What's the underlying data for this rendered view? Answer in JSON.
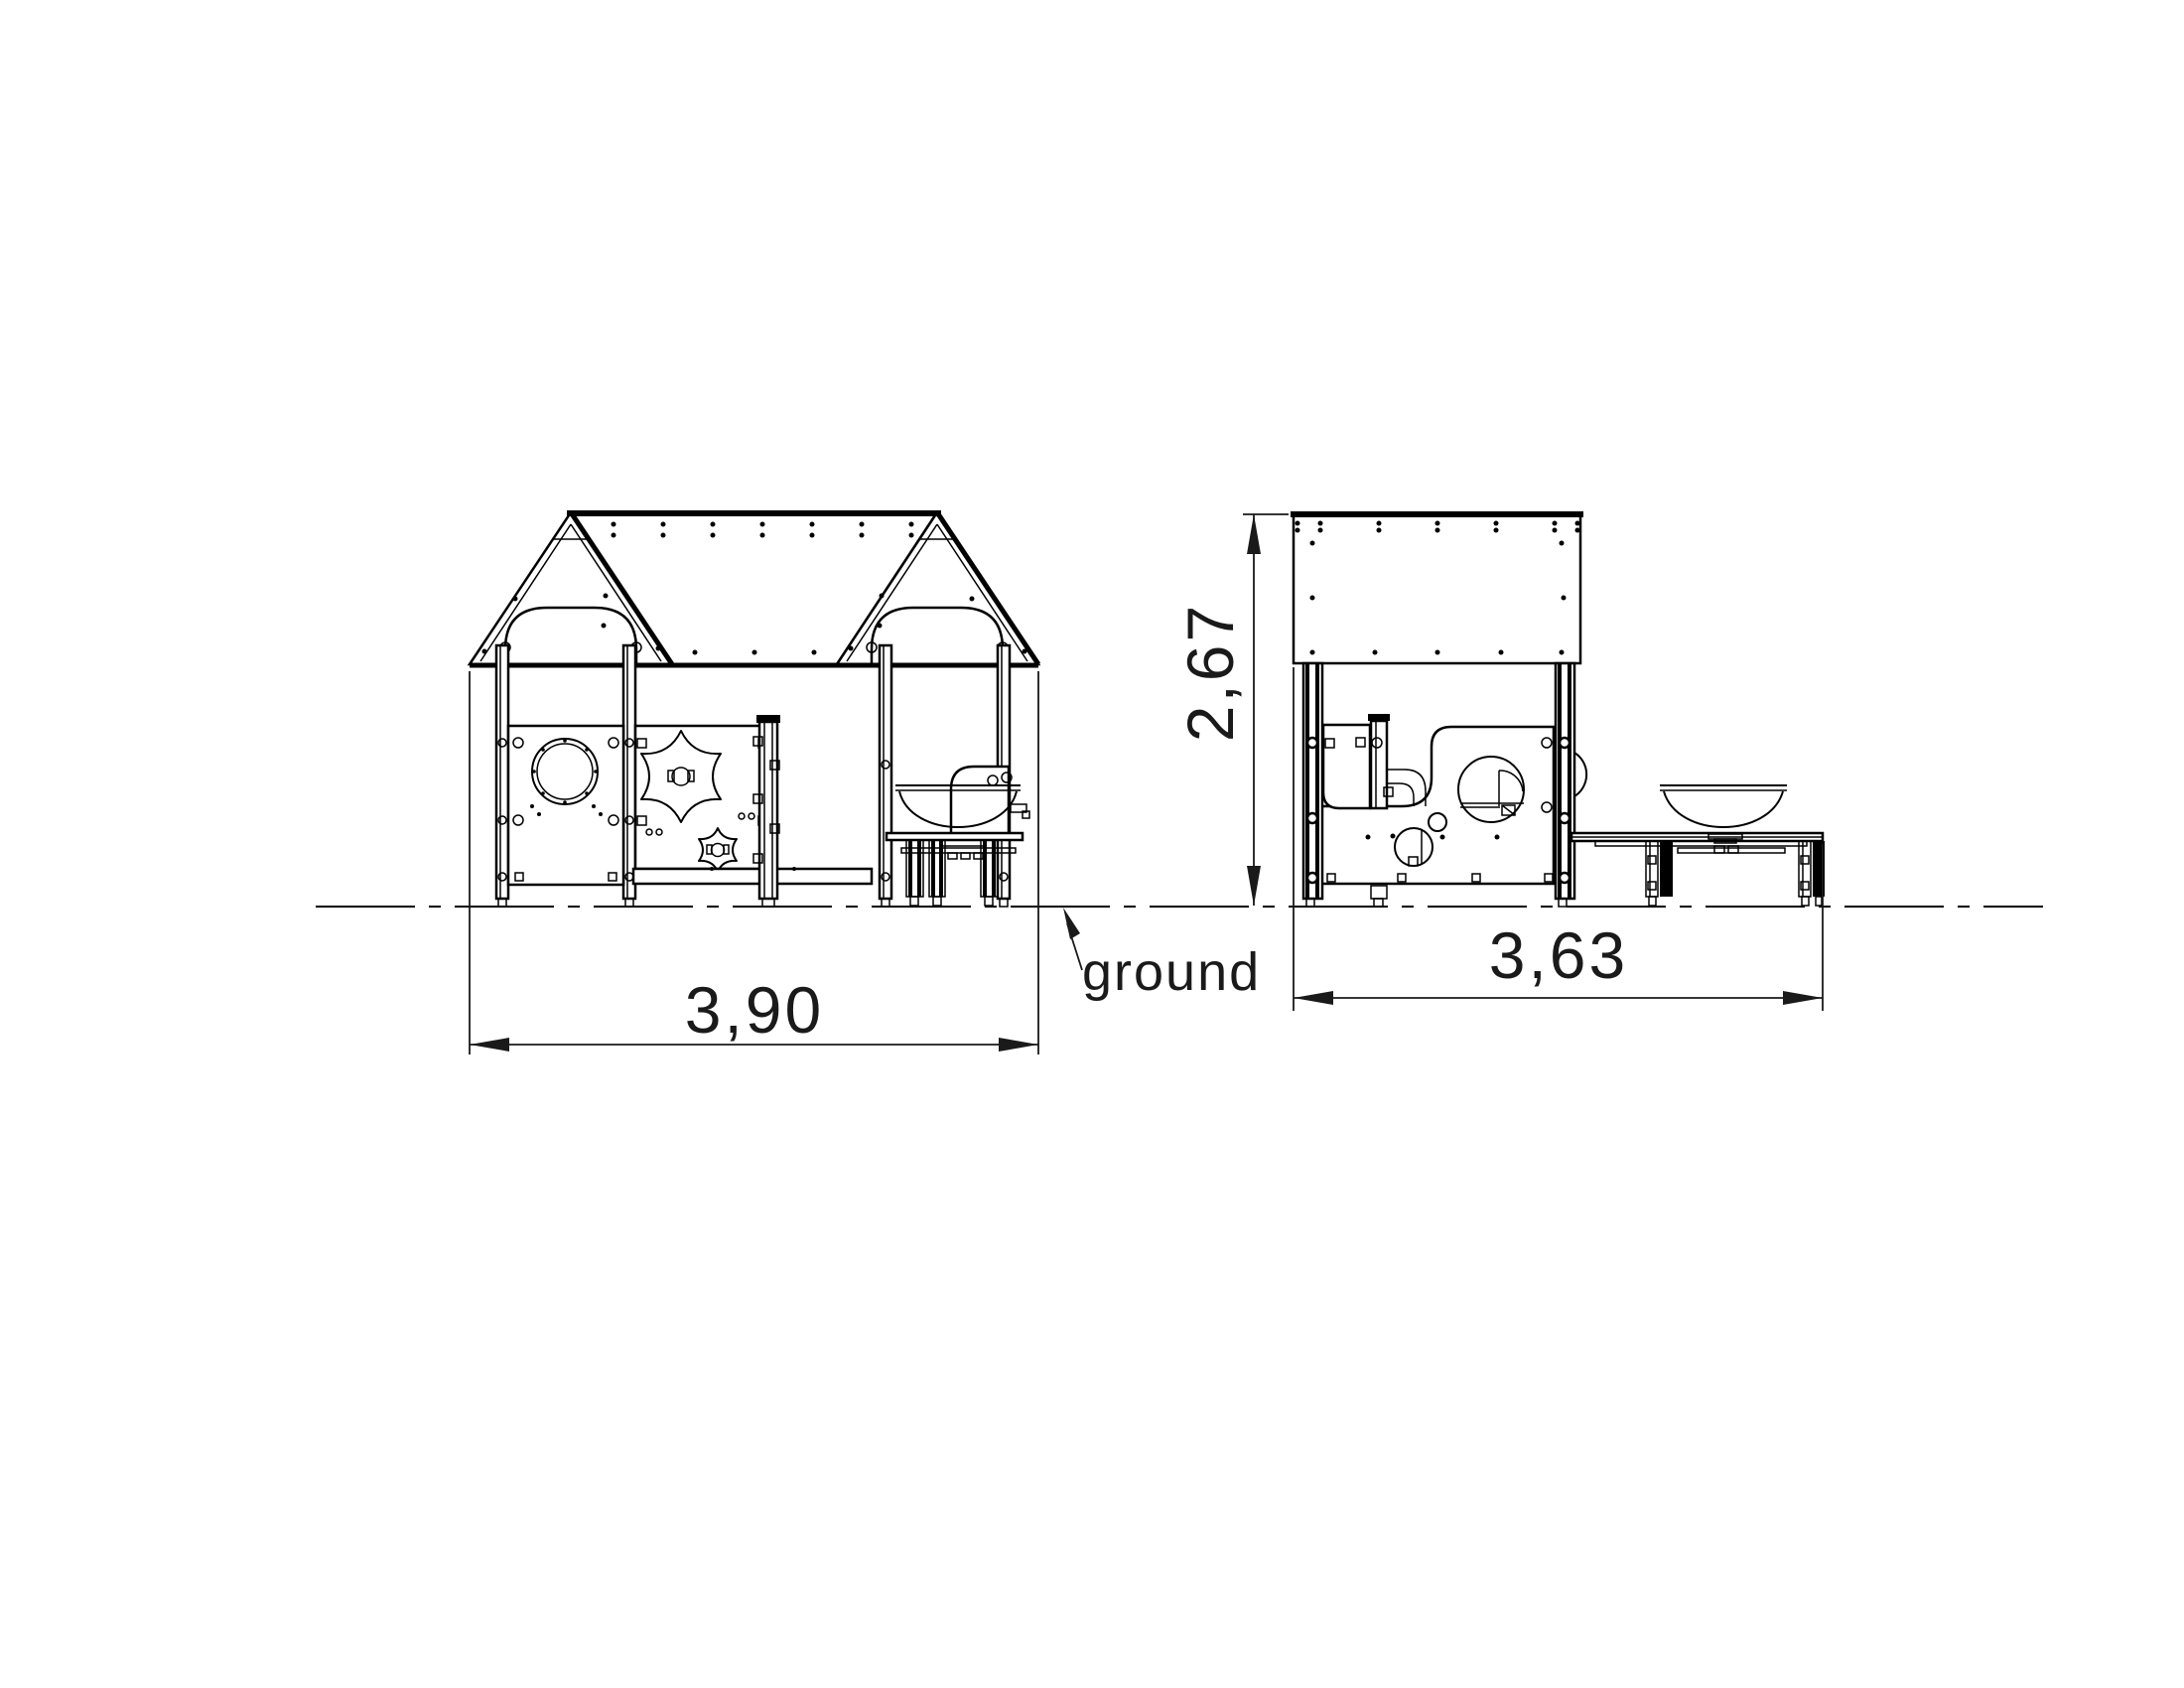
{
  "drawing": {
    "background_color": "#ffffff",
    "line_color": "#000000",
    "text_color": "#1a1a1a",
    "front_view": {
      "width_dimension": "3,90"
    },
    "side_view": {
      "height_dimension": "2,67",
      "depth_dimension": "3,63"
    },
    "ground_label": "ground"
  }
}
